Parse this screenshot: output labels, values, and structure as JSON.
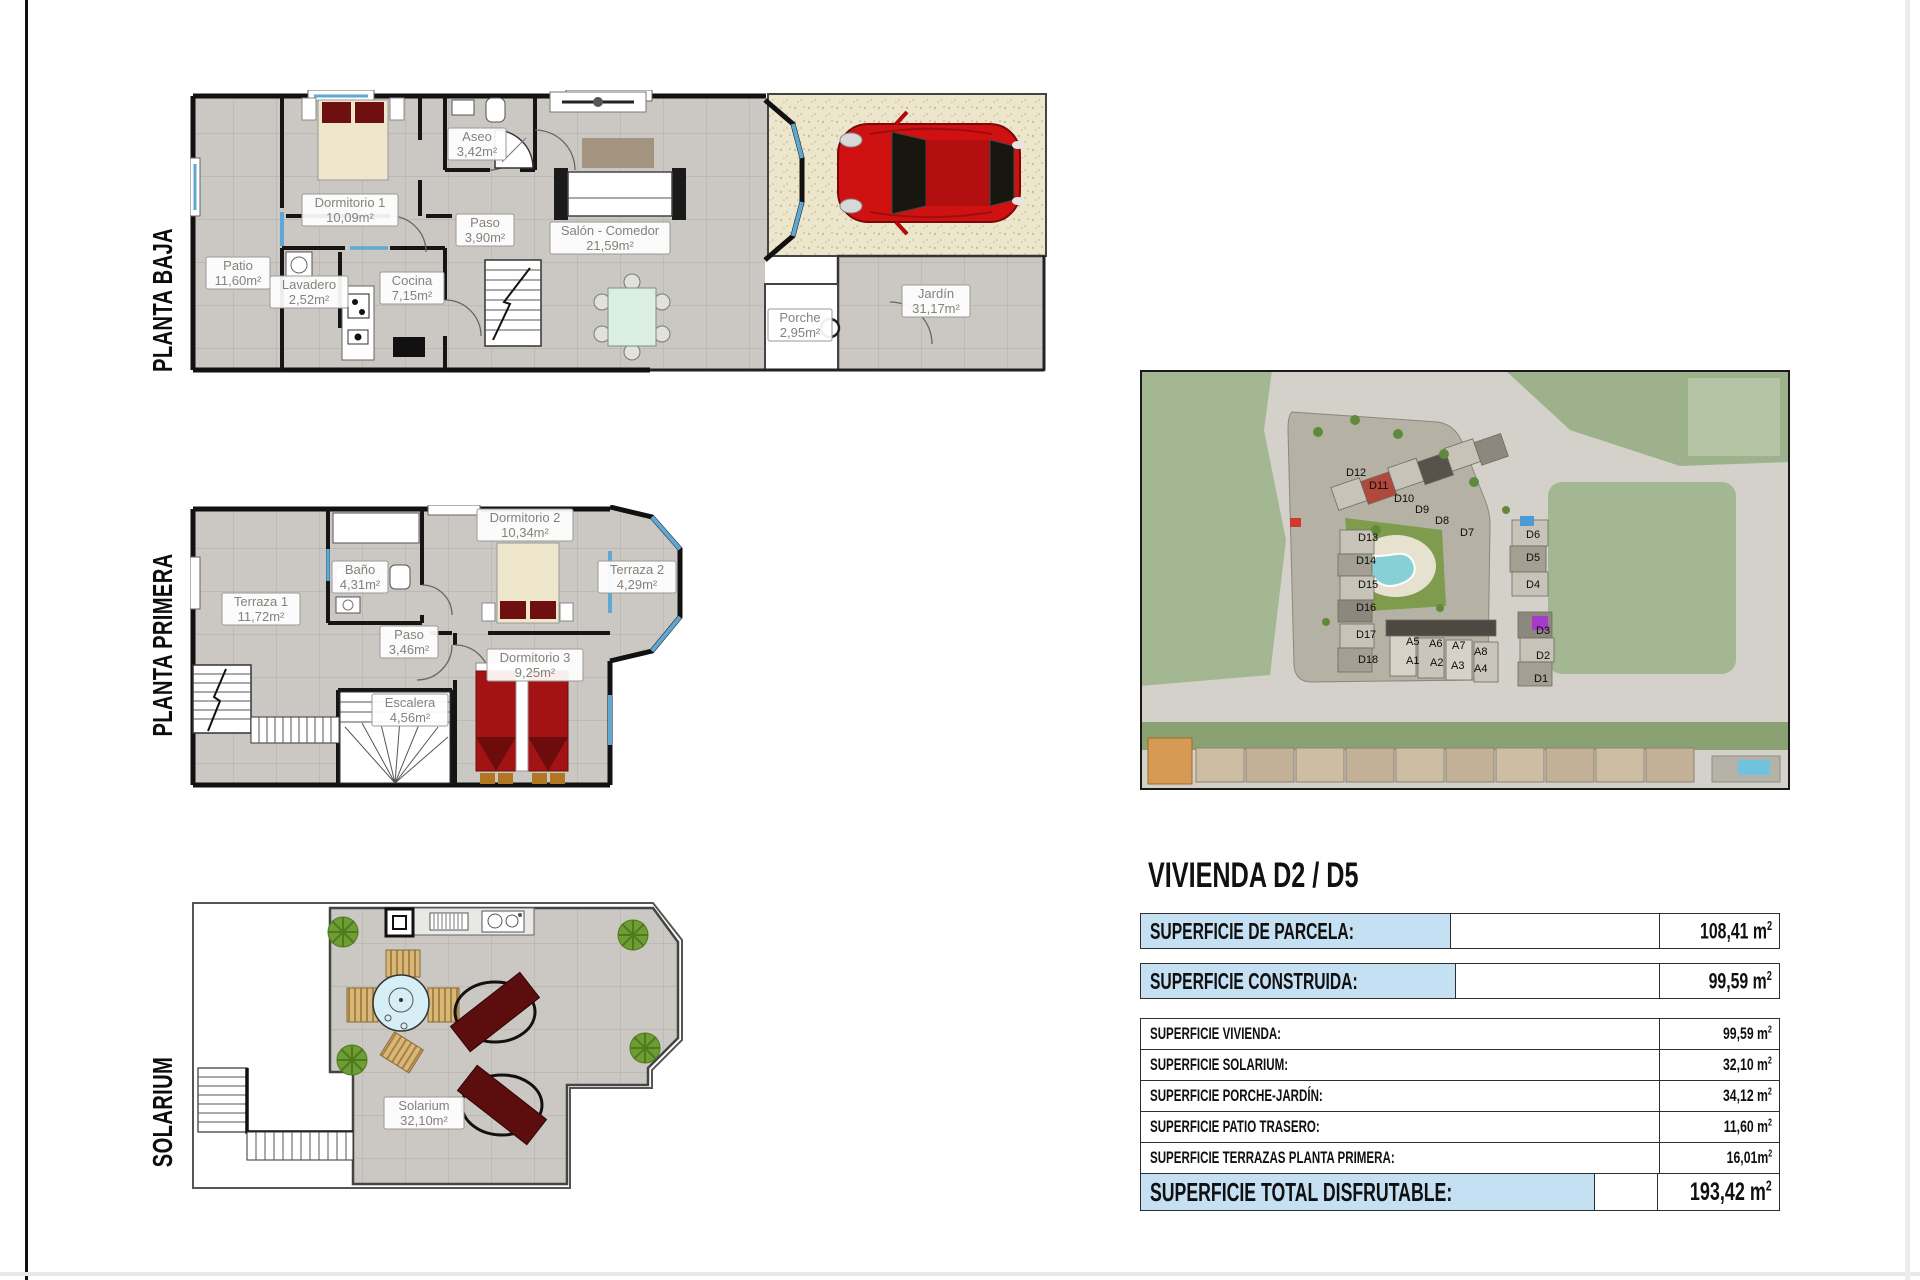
{
  "floor_titles": {
    "baja": "PLANTA BAJA",
    "primera": "PLANTA PRIMERA",
    "solarium": "SOLARIUM"
  },
  "plans": {
    "baja": {
      "rooms": [
        {
          "name": "Patio",
          "area": "11,60m²"
        },
        {
          "name": "Dormitorio 1",
          "area": "10,09m²"
        },
        {
          "name": "Aseo",
          "area": "3,42m²"
        },
        {
          "name": "Paso",
          "area": "3,90m²"
        },
        {
          "name": "Salón - Comedor",
          "area": "21,59m²"
        },
        {
          "name": "Lavadero",
          "area": "2,52m²"
        },
        {
          "name": "Cocina",
          "area": "7,15m²"
        },
        {
          "name": "Porche",
          "area": "2,95m²"
        },
        {
          "name": "Jardín",
          "area": "31,17m²"
        }
      ]
    },
    "primera": {
      "rooms": [
        {
          "name": "Terraza 1",
          "area": "11,72m²"
        },
        {
          "name": "Baño",
          "area": "4,31m²"
        },
        {
          "name": "Dormitorio 2",
          "area": "10,34m²"
        },
        {
          "name": "Terraza 2",
          "area": "4,29m²"
        },
        {
          "name": "Paso",
          "area": "3,46m²"
        },
        {
          "name": "Dormitorio 3",
          "area": "9,25m²"
        },
        {
          "name": "Escalera",
          "area": "4,56m²"
        }
      ]
    },
    "solarium": {
      "rooms": [
        {
          "name": "Solarium",
          "area": "32,10m²"
        }
      ]
    }
  },
  "site_map": {
    "units": [
      "D12",
      "D11",
      "D10",
      "D9",
      "D8",
      "D7",
      "D13",
      "D14",
      "D15",
      "D16",
      "D17",
      "D18",
      "D6",
      "D5",
      "D4",
      "D3",
      "D2",
      "D1",
      "A5",
      "A6",
      "A7",
      "A8",
      "A1",
      "A2",
      "A3",
      "A4"
    ]
  },
  "summary": {
    "title": "VIVIENDA D2 / D5",
    "rows_highlight": [
      {
        "label": "SUPERFICIE DE PARCELA:",
        "value": "108,41 m",
        "sup": "2"
      },
      {
        "label": "SUPERFICIE CONSTRUIDA:",
        "value": "99,59 m",
        "sup": "2"
      }
    ],
    "rows": [
      {
        "label": "SUPERFICIE VIVIENDA:",
        "value": "99,59 m",
        "sup": "2"
      },
      {
        "label": "SUPERFICIE SOLARIUM:",
        "value": "32,10 m",
        "sup": "2"
      },
      {
        "label": "SUPERFICIE PORCHE-JARDÍN:",
        "value": "34,12 m",
        "sup": "2"
      },
      {
        "label": "SUPERFICIE PATIO TRASERO:",
        "value": "11,60 m",
        "sup": "2"
      },
      {
        "label": "SUPERFICIE TERRAZAS PLANTA PRIMERA:",
        "value": "16,01m",
        "sup": "2"
      }
    ],
    "total": {
      "label": "SUPERFICIE TOTAL DISFRUTABLE:",
      "value": "193,42 m",
      "sup": "2"
    }
  },
  "colors": {
    "highlight_blue": "#c5e0f2",
    "tile_gray": "#cbc8c3",
    "wall_black": "#111111",
    "window_blue": "#5fa8d4",
    "car_red": "#d01112",
    "bed_maroon": "#6e0f10",
    "lounger_maroon": "#5c0d0e"
  }
}
